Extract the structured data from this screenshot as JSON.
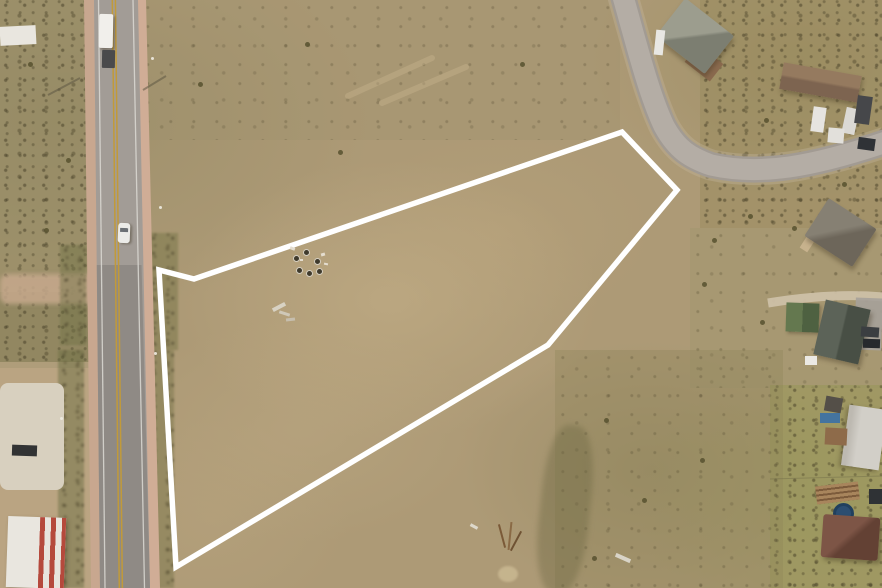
{
  "scene": {
    "type": "aerial-drone-photo",
    "description": "Drone aerial view of a vacant tan land parcel outlined in white, bordered by a two-lane highway on the left and a curved gray residential road at the top right, with rural houses, outbuildings and parked vehicles around the edges",
    "boundary": {
      "points": "622,132 677,190 548,345 176,567 159,270 194,279",
      "stroke": "#ffffff",
      "stroke_width": 5.5
    },
    "roads": {
      "main_highway": {
        "shoulder_left": "84,0 95,0 102,588 91,588",
        "shoulder_right": "136,0 146,0 160,588 149,588",
        "surface": "94,0 138,0 150,588 100,588",
        "surface_lower": "96.8,265 141.5,265 150,588 100,588",
        "edge_left": "M 98.5,0 L 105,588",
        "edge_right": "M 133,0 L 144.5,588",
        "center_1": "M 112.3,0 L 119.3,588",
        "center_2": "M 115.4,0 L 122.4,588"
      },
      "side_road": {
        "d": "M 620,-14 C 636,42 648,92 664,126 C 677,150 691,158 711,165 C 760,176 812,167 886,142"
      },
      "driveway_right": {
        "d": "M 768,303 C 810,296 850,294 884,297"
      },
      "track_1": "M 348,96 L 432,58",
      "track_2": "M 382,103 L 466,67",
      "pole_shadow_1": "M 48,95 L 80,78",
      "pole_shadow_2": "M 143,90 L 166,76",
      "fence_line": "M 770,479 L 882,476"
    },
    "colors": {
      "boundary_white": "#ffffff",
      "land_tan": "#ad9a76",
      "parcel_light_wash": "#c6b189",
      "scrub_olive": "#8f8760",
      "scrub_dark_olive": "#7c7850",
      "grass_yellow_green": "#9a9a58",
      "asphalt_light": "#a29c96",
      "asphalt_dark": "#8f8a85",
      "side_road_gray": "#b4ada5",
      "shoulder_pink": "#c8a78f",
      "center_line_yellow": "#c19a3a",
      "edge_line_white": "#dcd9d4",
      "dirt_crossing_pink": "#c6a88c",
      "concrete_pad": "#d8d0bf",
      "roof_gray_green": "#9c9d8e",
      "roof_long_brown": "#8d7258",
      "roof_gray_brown": "#868073",
      "roof_cabin_green": "#64784f",
      "roof_dark_gray_green": "#5c6358",
      "roof_light_metal": "#cecbc4",
      "roof_red_brown": "#6f4a3c",
      "warehouse_stripe_red": "#b5493c",
      "trampoline_blue": "#2c4e71",
      "tarp_blue": "#44749f"
    },
    "features": [
      "vacant-parcel-outlined",
      "two-lane-highway",
      "box-truck-on-highway",
      "white-car-on-highway",
      "curved-residential-road",
      "gray-gable-house",
      "long-brown-roof-house",
      "parked-trailers",
      "gray-brown-gable-house",
      "green-cabin",
      "dark-roof-building",
      "light-metal-building",
      "red-brown-hip-roof-house",
      "trampoline",
      "lumber-pile",
      "debris-cluster-in-parcel",
      "concrete-pad",
      "red-striped-warehouse-roof"
    ]
  }
}
